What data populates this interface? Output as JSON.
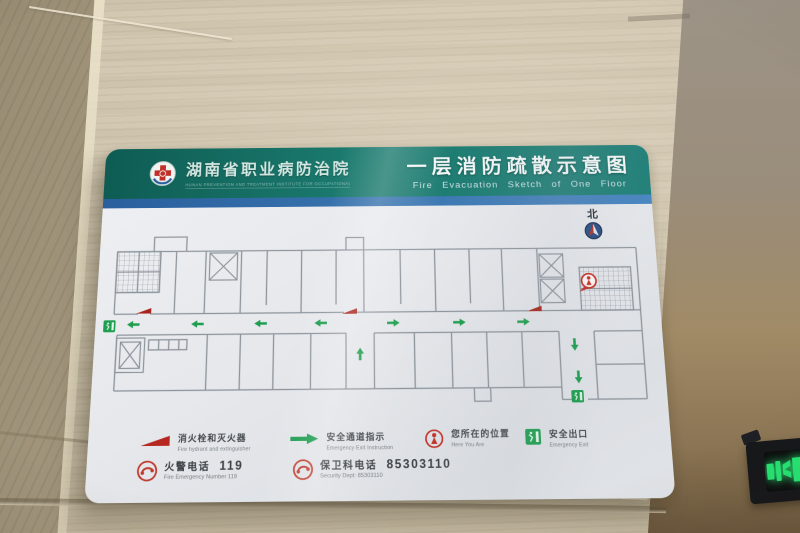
{
  "colors": {
    "header_teal": "#1b7a6e",
    "strip_blue": "#3a76b0",
    "route_green": "#1f9e4f",
    "alert_red": "#c0392b",
    "exit_green": "#1e9e50",
    "wall_beige": "#cdc3ad"
  },
  "sign": {
    "header": {
      "org_zh": "湖南省职业病防治院",
      "org_en": "HUNAN PREVENTION AND TREATMENT INSTITUTE FOR OCCUPATIONAL DISEASES",
      "title_zh": "一层消防疏散示意图",
      "title_en": "Fire Evacuation Sketch of One Floor"
    },
    "plan": {
      "north_label": "北"
    },
    "legend": {
      "items": [
        {
          "icon": "fire-hydrant",
          "zh": "消火栓和灭火器",
          "en": "Fire hydrant and extinguisher"
        },
        {
          "icon": "route-arrow",
          "zh": "安全通道指示",
          "en": "Emergency Exit Instruction"
        },
        {
          "icon": "here-you-are",
          "zh": "您所在的位置",
          "en": "Here You Are"
        },
        {
          "icon": "emergency-exit",
          "zh": "安全出口",
          "en": "Emergency Exit"
        }
      ],
      "phones": [
        {
          "icon": "telephone",
          "zh": "火警电话",
          "number": "119",
          "en": "Fire Emergency Number 119"
        },
        {
          "icon": "telephone",
          "zh": "保卫科电话",
          "number": "85303110",
          "en": "Security Dept: 85303110"
        }
      ]
    }
  }
}
